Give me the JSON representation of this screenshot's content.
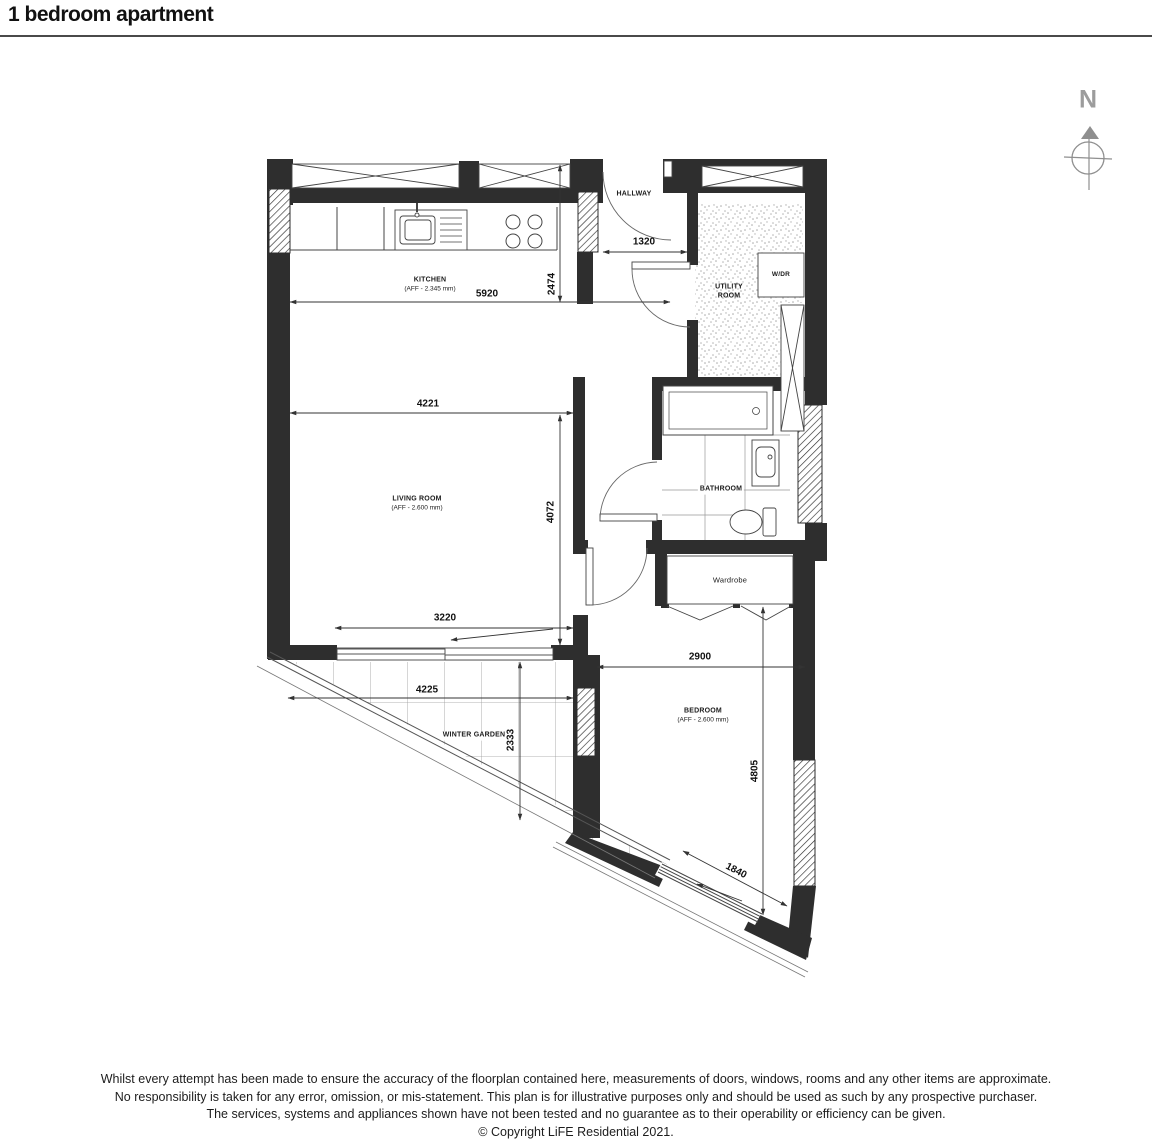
{
  "page": {
    "title": "1 bedroom apartment"
  },
  "compass": {
    "north_label": "N"
  },
  "rooms": {
    "hallway": {
      "name": "HALLWAY"
    },
    "kitchen": {
      "name": "KITCHEN",
      "aff": "(AFF - 2.345 mm)"
    },
    "living_room": {
      "name": "LIVING ROOM",
      "aff": "(AFF - 2.600 mm)"
    },
    "utility_room": {
      "name": "UTILITY ROOM"
    },
    "wdr": {
      "name": "W/DR"
    },
    "bathroom": {
      "name": "BATHROOM"
    },
    "wardrobe": {
      "name": "Wardrobe"
    },
    "bedroom": {
      "name": "BEDROOM",
      "aff": "(AFF - 2.600 mm)"
    },
    "winter_garden": {
      "name": "WINTER GARDEN"
    }
  },
  "dimensions": {
    "hallway_width": "1320",
    "kitchen_width": "5920",
    "kitchen_depth": "2474",
    "living_width": "4221",
    "living_depth": "4072",
    "living_door_width": "3220",
    "winter_garden_width": "4225",
    "winter_garden_depth": "2333",
    "bedroom_width": "2900",
    "bedroom_depth": "4805",
    "bedroom_window_width": "1840"
  },
  "footer": {
    "line1": "Whilst every attempt has been made to ensure the accuracy of the floorplan contained here, measurements of doors, windows, rooms and any other items are approximate.",
    "line2": "No responsibility is taken for any error, omission, or mis-statement. This plan is for illustrative purposes only and should be used as such by any prospective purchaser.",
    "line3": "The services, systems and appliances shown have not been tested and no guarantee as to their operability or efficiency can be given.",
    "line4": "© Copyright LiFE Residential 2021."
  },
  "colors": {
    "wall": "#2e2e2e",
    "line": "#444444",
    "compass": "#8f8f8f"
  }
}
